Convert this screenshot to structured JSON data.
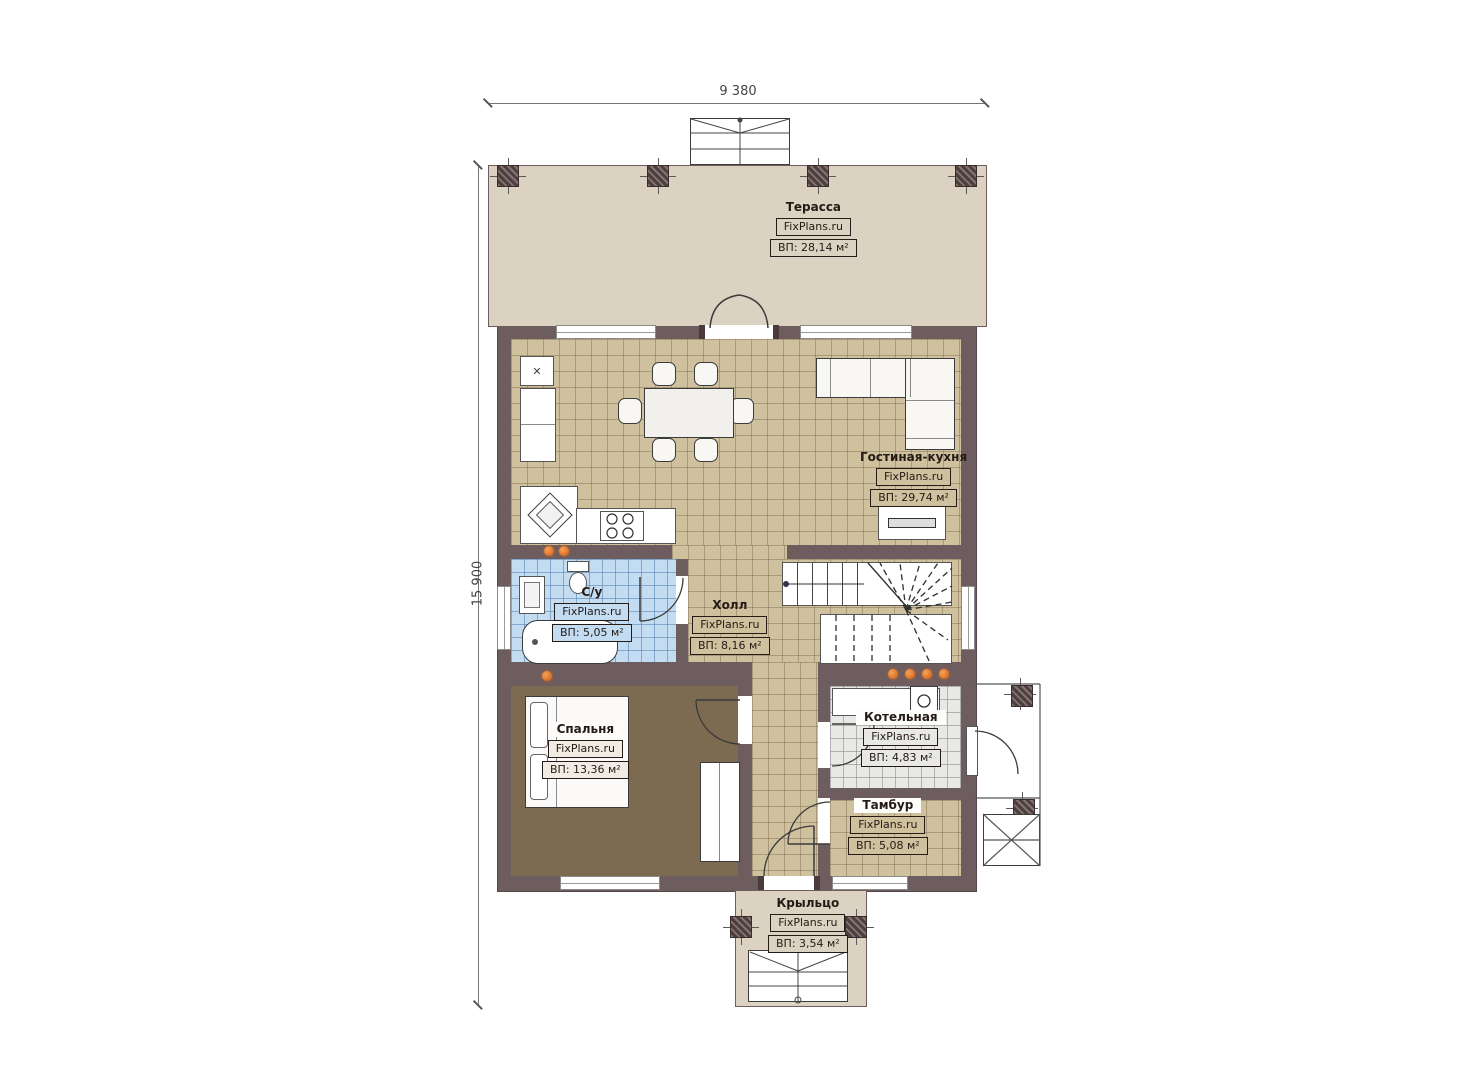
{
  "branding": "FixPlans.ru",
  "dimensions": {
    "width_label": "9 380",
    "height_label": "15 900"
  },
  "rooms": {
    "terrace": {
      "name": "Терасса",
      "area": "ВП: 28,14 м²"
    },
    "living_kitchen": {
      "name": "Гостиная-кухня",
      "area": "ВП: 29,74 м²"
    },
    "bathroom": {
      "name": "С/у",
      "area": "ВП: 5,05 м²"
    },
    "hall": {
      "name": "Холл",
      "area": "ВП: 8,16 м²"
    },
    "bedroom": {
      "name": "Спальня",
      "area": "ВП: 13,36 м²"
    },
    "boiler": {
      "name": "Котельная",
      "area": "ВП: 4,83 м²"
    },
    "tambour": {
      "name": "Тамбур",
      "area": "ВП: 5,08 м²"
    },
    "porch": {
      "name": "Крыльцо",
      "area": "ВП: 3,54 м²"
    }
  },
  "colors": {
    "wall": "#6e5d5e",
    "terrace_fill": "#dcd2c2",
    "tile_tan": "#cfc09e",
    "tile_blue": "#c3dcf2",
    "tile_gray": "#e8e8e6",
    "bedroom_floor": "#7c6b51",
    "radiator_orange": "#dd6f22"
  }
}
